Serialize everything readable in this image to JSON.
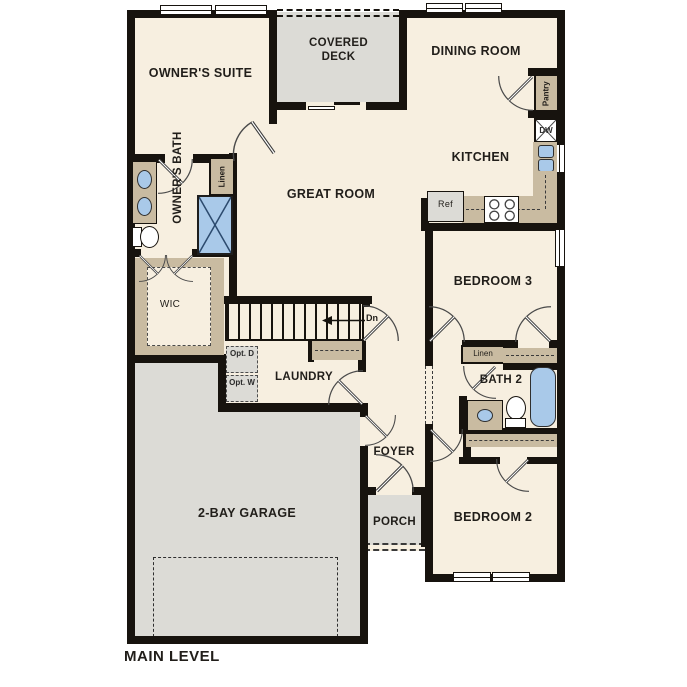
{
  "title": "MAIN LEVEL",
  "colors": {
    "wall": "#17130e",
    "floor": "#f7efe0",
    "patio_gray": "#dcdbd6",
    "cabinet_tan": "#c9bba1",
    "fixture_blue": "#a9c9e9"
  },
  "rooms": {
    "owners_suite": "OWNER'S SUITE",
    "covered_deck": "COVERED DECK",
    "dining_room": "DINING ROOM",
    "kitchen": "KITCHEN",
    "great_room": "GREAT ROOM",
    "owners_bath": "OWNER'S BATH",
    "wic": "WIC",
    "laundry": "LAUNDRY",
    "foyer": "FOYER",
    "porch": "PORCH",
    "garage": "2-BAY GARAGE",
    "bedroom2": "BEDROOM 2",
    "bedroom3": "BEDROOM 3",
    "bath2": "BATH 2"
  },
  "labels": {
    "pantry": "Pantry",
    "dishwasher": "DW",
    "refrigerator": "Ref",
    "linen_owners": "Linen",
    "linen_hall": "Linen",
    "stairs_down": "Dn",
    "optional_dryer": "Opt. D",
    "optional_washer": "Opt. W"
  }
}
